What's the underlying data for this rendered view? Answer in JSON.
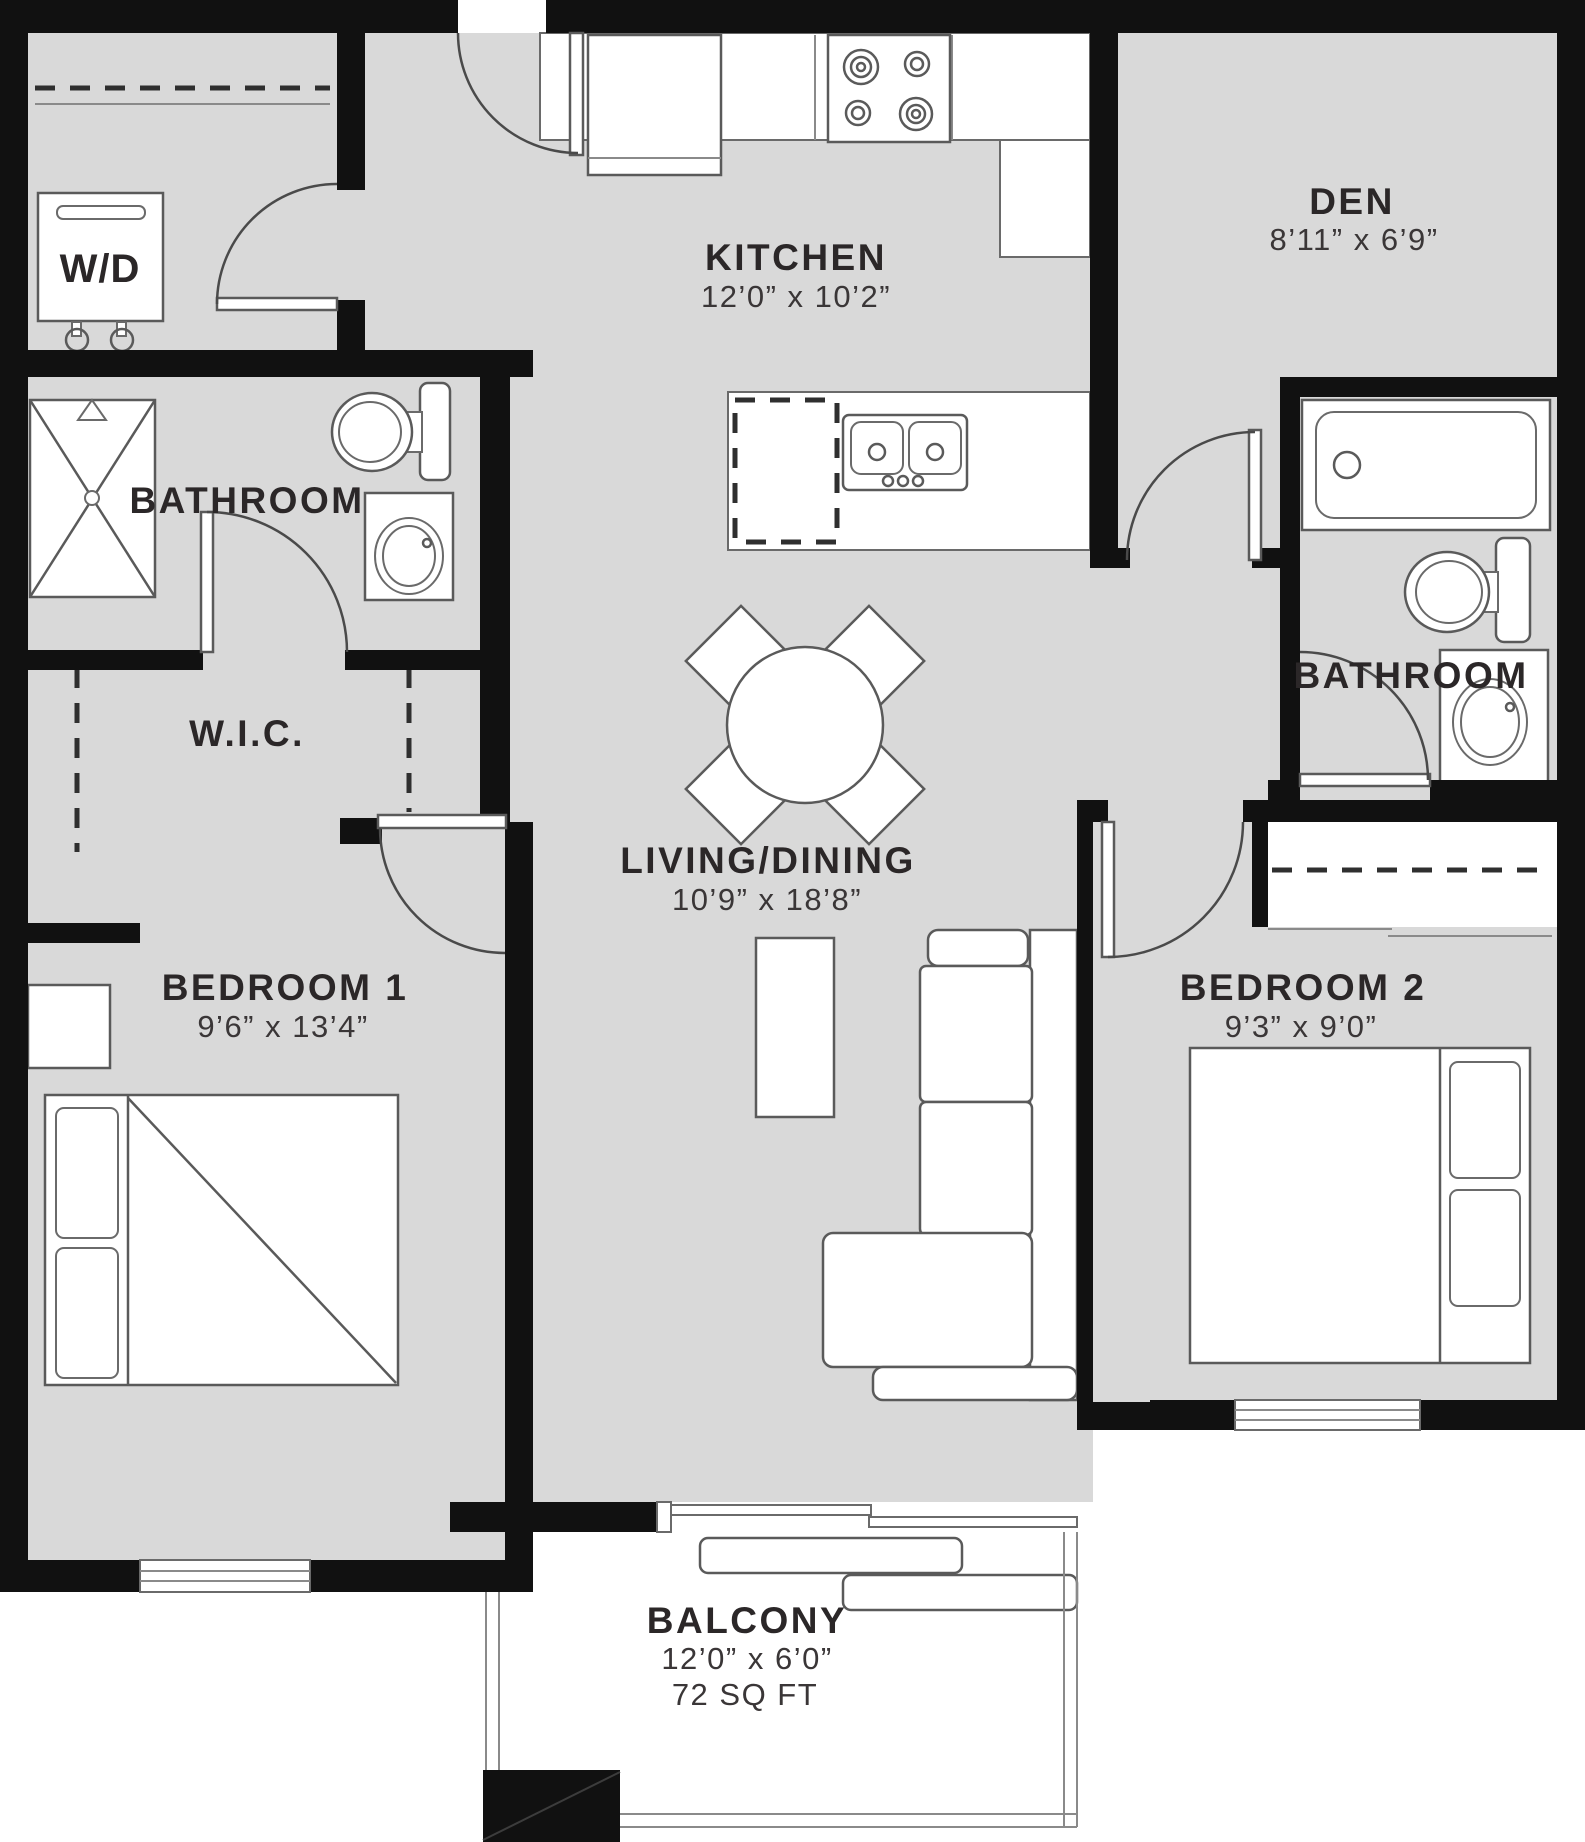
{
  "title": "Apartment floor plan",
  "colors": {
    "floor": "#d9d9d9",
    "wall": "#111111",
    "fixture_line": "#5a5a5a",
    "text": "#2b2728"
  },
  "rooms": {
    "kitchen": {
      "name": "KITCHEN",
      "dims": "12’0” x 10’2”"
    },
    "den": {
      "name": "DEN",
      "dims": "8’11” x 6’9”"
    },
    "bathroom1": {
      "name": "BATHROOM"
    },
    "wic": {
      "name": "W.I.C."
    },
    "living_dining": {
      "name": "LIVING/DINING",
      "dims": "10’9” x 18’8”"
    },
    "bedroom1": {
      "name": "BEDROOM 1",
      "dims": "9’6” x 13’4”"
    },
    "bedroom2": {
      "name": "BEDROOM 2",
      "dims": "9’3” x 9’0”"
    },
    "bathroom2": {
      "name": "BATHROOM"
    },
    "balcony": {
      "name": "BALCONY",
      "dims": "12’0” x 6’0”",
      "area": "72 SQ FT"
    },
    "laundry": {
      "name": "W/D"
    }
  },
  "fixtures": [
    "washer-dryer",
    "shower",
    "toilet",
    "vanity-sink",
    "fridge",
    "stove",
    "kitchen-island",
    "double-sink",
    "dishwasher",
    "dining-table",
    "dining-chair",
    "tv-console",
    "sofa-sectional",
    "bed",
    "nightstand",
    "bathtub",
    "closet-rod",
    "window",
    "door",
    "balcony-railing",
    "balcony-column"
  ]
}
